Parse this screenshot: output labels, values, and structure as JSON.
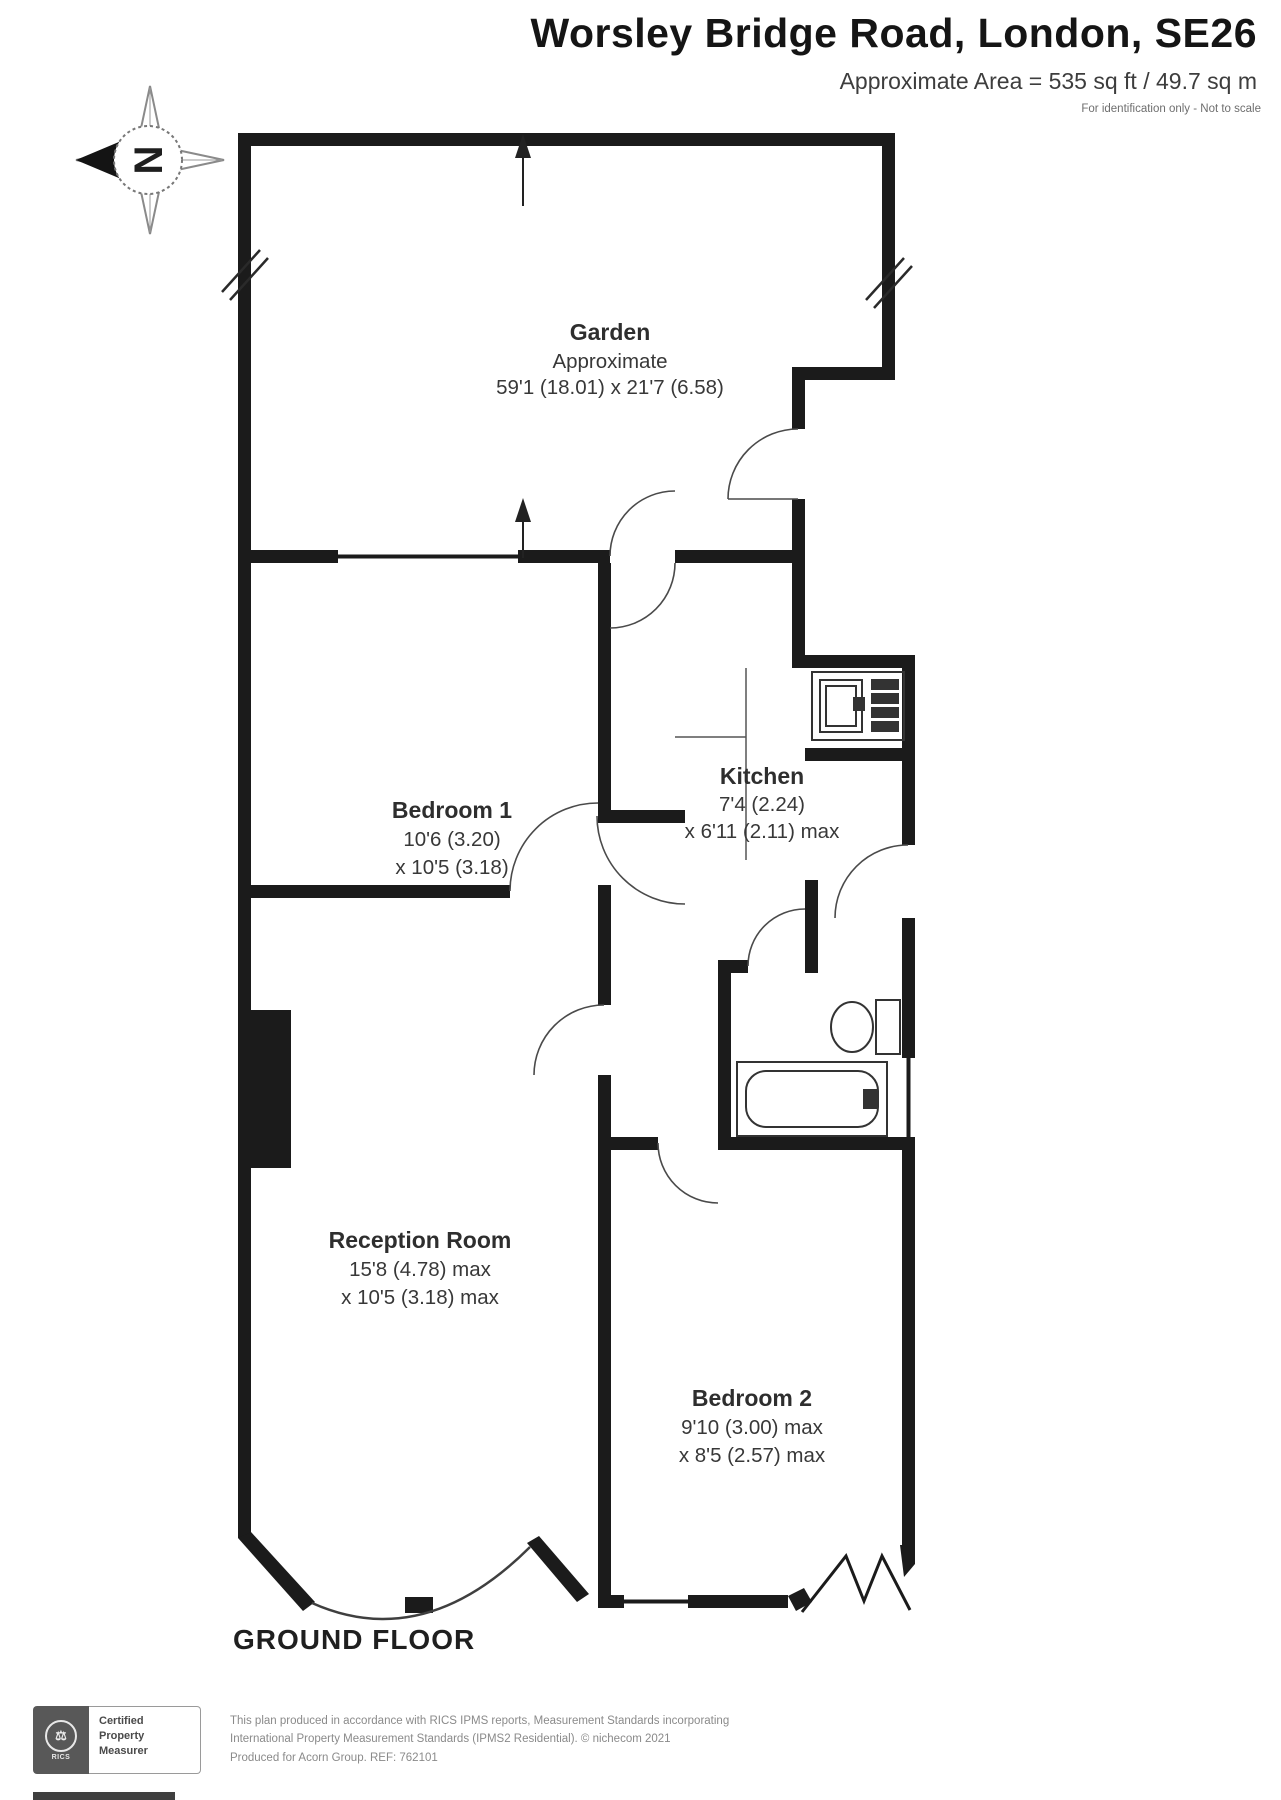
{
  "header": {
    "title": "Worsley Bridge Road, London, SE26",
    "subtitle": "Approximate Area = 535 sq ft / 49.7 sq m",
    "note": "For identification only - Not to scale"
  },
  "compass": {
    "north_label": "N"
  },
  "rooms": {
    "garden": {
      "name": "Garden",
      "qualifier": "Approximate",
      "dims": "59'1 (18.01) x 21'7 (6.58)"
    },
    "bedroom1": {
      "name": "Bedroom 1",
      "dims_line1": "10'6 (3.20)",
      "dims_line2": "x 10'5 (3.18)"
    },
    "kitchen": {
      "name": "Kitchen",
      "dims_line1": "7'4 (2.24)",
      "dims_line2": "x 6'11 (2.11) max"
    },
    "reception": {
      "name": "Reception Room",
      "dims_line1": "15'8 (4.78) max",
      "dims_line2": "x 10'5 (3.18) max"
    },
    "bedroom2": {
      "name": "Bedroom 2",
      "dims_line1": "9'10 (3.00) max",
      "dims_line2": "x 8'5 (2.57) max"
    }
  },
  "floor_label": "GROUND FLOOR",
  "footer": {
    "badge": {
      "emblem": "RICS",
      "line1": "Certified",
      "line2": "Property",
      "line3": "Measurer"
    },
    "line1": "This plan produced in accordance with RICS IPMS reports, Measurement Standards incorporating",
    "line2": "International Property Measurement Standards (IPMS2 Residential).  © nichecom 2021",
    "line3": "Produced for Acorn Group.   REF: 762101"
  },
  "colors": {
    "wall": "#1b1b1b",
    "thin_line": "#4a4a4a",
    "text": "#333333"
  }
}
